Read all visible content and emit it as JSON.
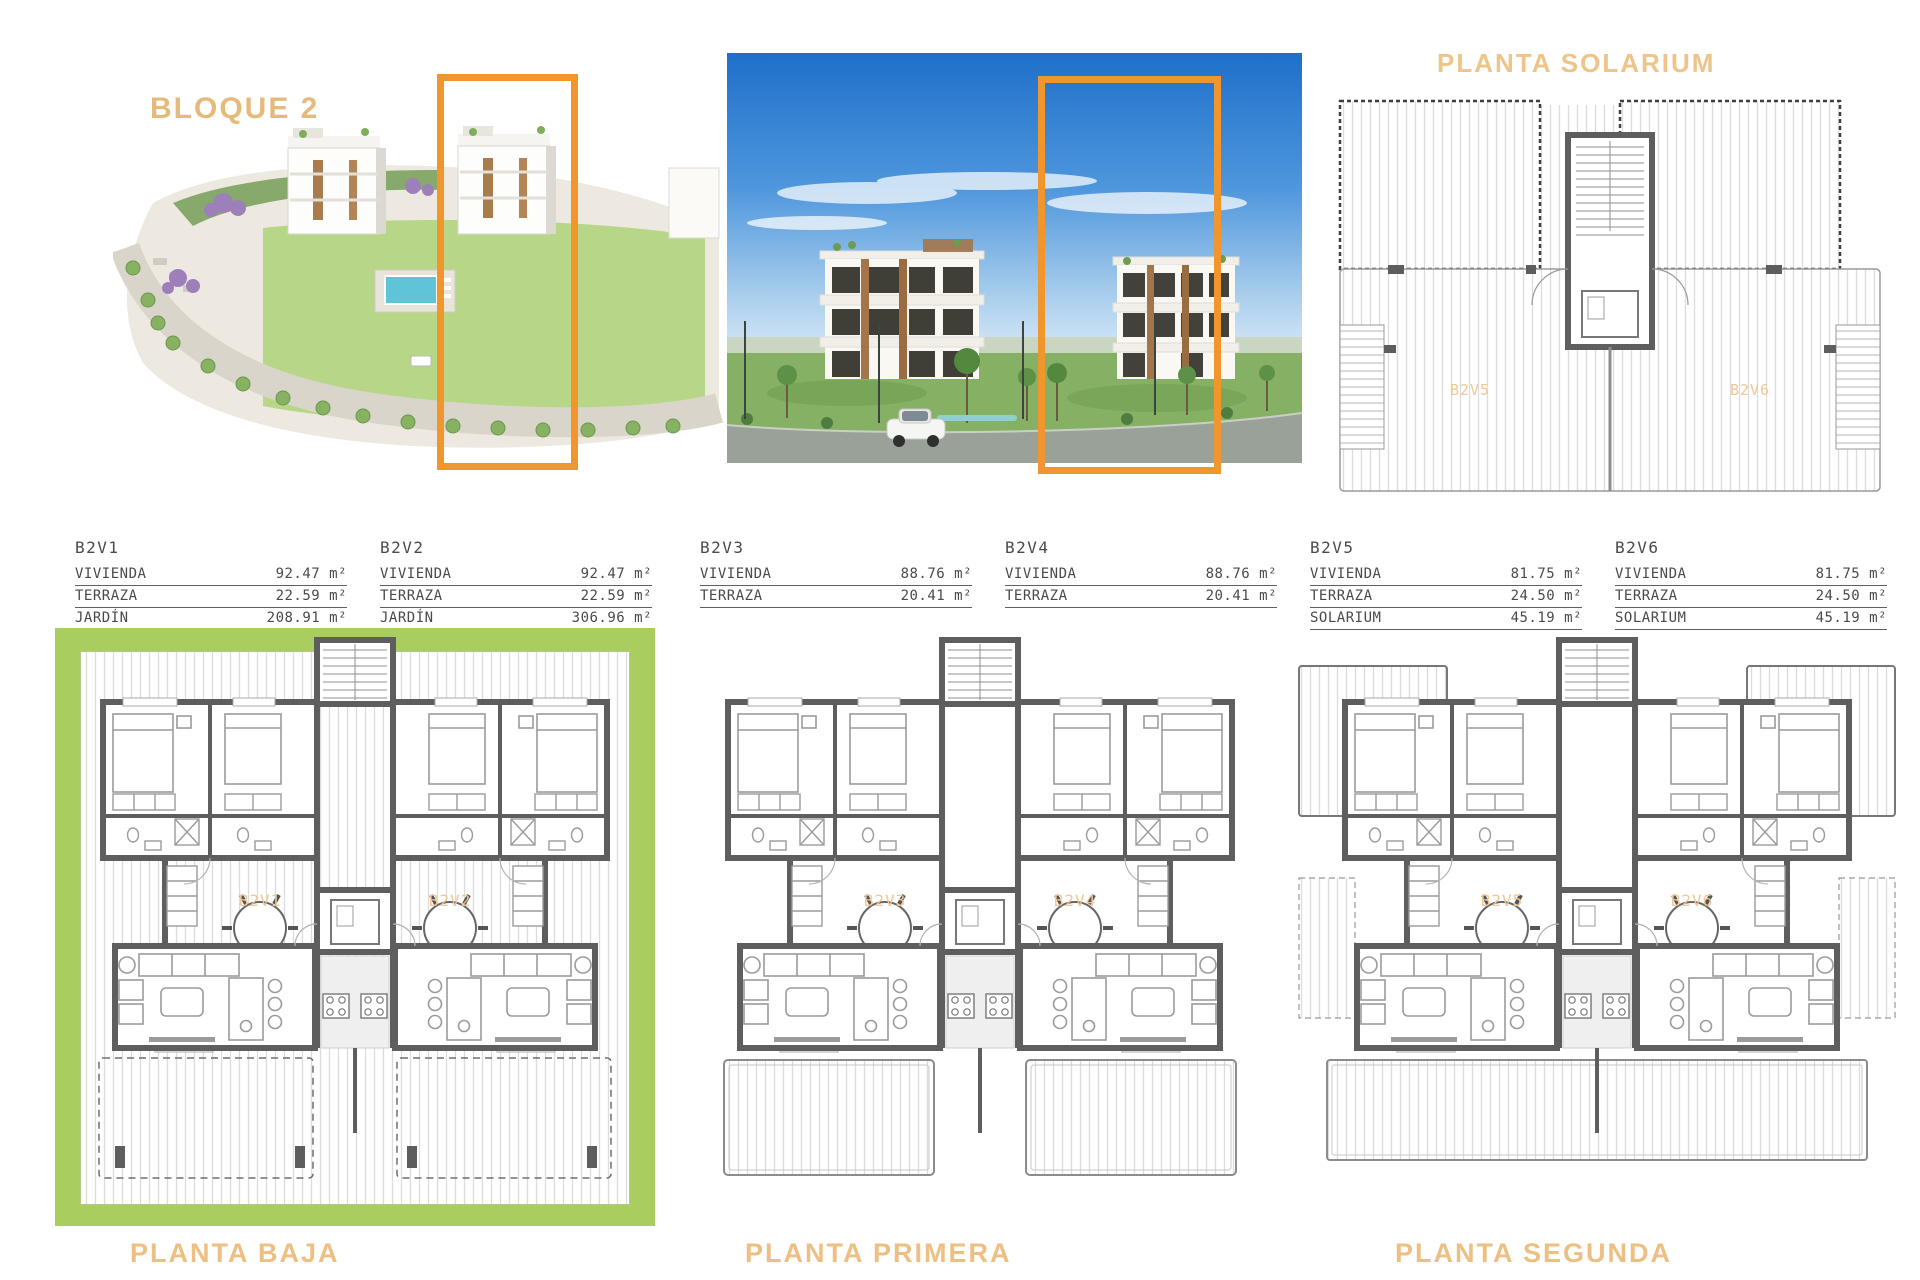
{
  "header": {
    "block_title": "BLOQUE 2",
    "solarium_title": "PLANTA SOLARIUM"
  },
  "area_tables": [
    {
      "unit": "B2V1",
      "rows": [
        {
          "label": "VIVIENDA",
          "value": "92.47 m²"
        },
        {
          "label": "TERRAZA",
          "value": "22.59 m²"
        },
        {
          "label": "JARDÍN",
          "value": "208.91 m²"
        }
      ]
    },
    {
      "unit": "B2V2",
      "rows": [
        {
          "label": "VIVIENDA",
          "value": "92.47 m²"
        },
        {
          "label": "TERRAZA",
          "value": "22.59 m²"
        },
        {
          "label": "JARDÍN",
          "value": "306.96 m²"
        }
      ]
    },
    {
      "unit": "B2V3",
      "rows": [
        {
          "label": "VIVIENDA",
          "value": "88.76 m²"
        },
        {
          "label": "TERRAZA",
          "value": "20.41 m²"
        }
      ]
    },
    {
      "unit": "B2V4",
      "rows": [
        {
          "label": "VIVIENDA",
          "value": "88.76 m²"
        },
        {
          "label": "TERRAZA",
          "value": "20.41 m²"
        }
      ]
    },
    {
      "unit": "B2V5",
      "rows": [
        {
          "label": "VIVIENDA",
          "value": "81.75 m²"
        },
        {
          "label": "TERRAZA",
          "value": "24.50 m²"
        },
        {
          "label": "SOLARIUM",
          "value": "45.19 m²"
        }
      ]
    },
    {
      "unit": "B2V6",
      "rows": [
        {
          "label": "VIVIENDA",
          "value": "81.75 m²"
        },
        {
          "label": "TERRAZA",
          "value": "24.50 m²"
        },
        {
          "label": "SOLARIUM",
          "value": "45.19 m²"
        }
      ]
    }
  ],
  "floor_labels": {
    "baja": "PLANTA BAJA",
    "primera": "PLANTA PRIMERA",
    "segunda": "PLANTA SEGUNDA"
  },
  "plan_unit_labels": {
    "baja": [
      "B2V1",
      "B2V2"
    ],
    "primera": [
      "B2V3",
      "B2V4"
    ],
    "segunda": [
      "B2V5",
      "B2V6"
    ],
    "solarium": [
      "B2V5",
      "B2V6"
    ]
  },
  "colors": {
    "highlight_orange": "#f0962d",
    "garden_green": "#a9ce5f",
    "accent_heading": "#e5bb7c",
    "plan_wall_gray": "#5e5e5e"
  }
}
